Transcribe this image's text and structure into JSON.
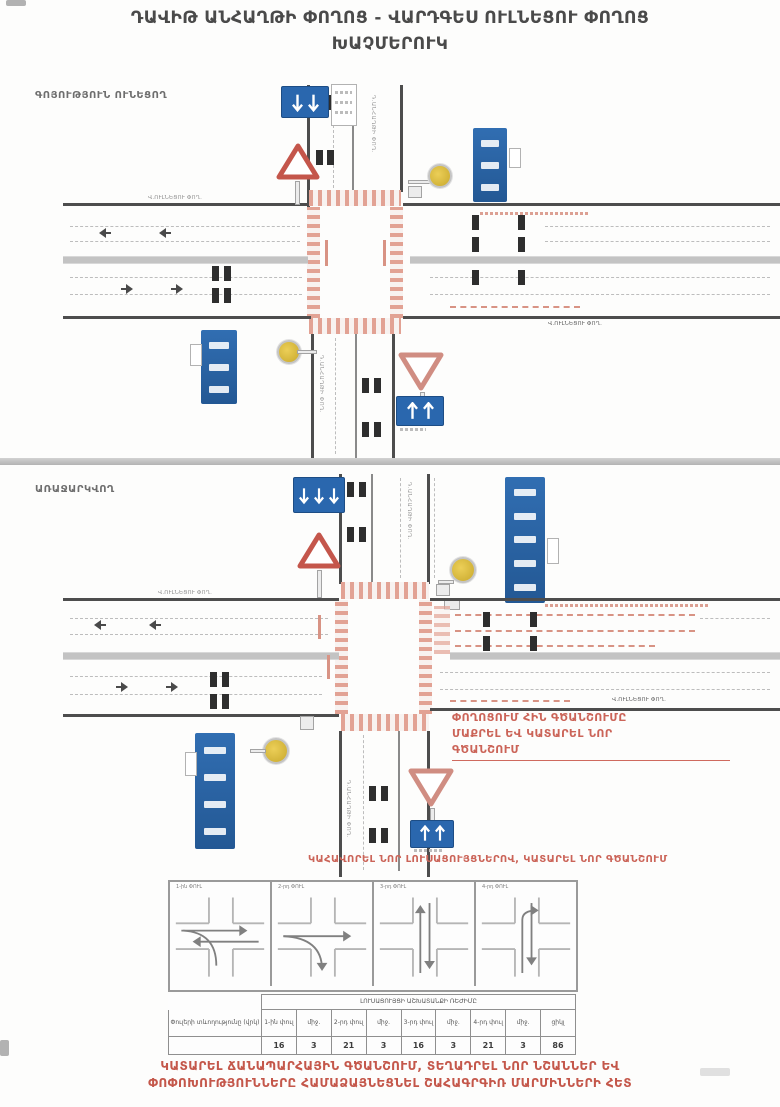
{
  "title": {
    "line1": "ԴԱՎԻԹ ԱՆՀԱՂԹԻ ՓՈՂՈՑ - ՎԱՐԴԳԵՍ ՈՒԼՆԵՑՈՒ ՓՈՂՈՑ",
    "line2": "ԽԱՉՄԵՐՈՒԿ"
  },
  "sections": {
    "existing_label": "ԳՈՅՈՒԹՅՈՒՆ ՈՒՆԵՑՈՂ",
    "proposed_label": "ԱՌԱՋԱՐԿՎՈՂ"
  },
  "streets": {
    "horizontal": "Վ.ՈՒԼՆԵՑՈՒ ՓՈՂ.",
    "vertical": "Դ.ԱՆՀԱՂԹԻ ՓՈՂ."
  },
  "notes": {
    "marking_note_line1": "ՓՈՂՈՑՈՒՄ ՀԻՆ ԳԾԱՆՇՈՒՄԸ",
    "marking_note_line2": "ՄԱՔՐԵԼ ԵՎ ԿԱՏԱՐԵԼ ՆՈՐ",
    "marking_note_line3": "ԳԾԱՆՇՈՒՄ",
    "signal_note": "ԿԱՀԱՎՈՐԵԼ ՆՈՐ ԼՈՒՍԱՑՈՒՅՑՆԵՐՈՎ, ԿԱՏԱՐԵԼ ՆՈՐ ԳԾԱՆՇՈՒՄ"
  },
  "phases": {
    "labels": [
      "1-ին ՓՈՒԼ",
      "2-րդ ՓՈՒԼ",
      "3-րդ ՓՈՒԼ",
      "4-րդ ՓՈՒԼ"
    ]
  },
  "table": {
    "title": "ԼՈՒՍԱՑՈՒՅՑԻ ԱՇԽԱՏԱՆՔԻ ՌԵԺԻՄԸ",
    "row_label": "Փուլերի տևողությունը (վրկ)",
    "columns": [
      "1-ին փուլ",
      "միջ.",
      "2-րդ փուլ",
      "միջ.",
      "3-րդ փուլ",
      "միջ.",
      "4-րդ փուլ",
      "միջ.",
      "ցիկլ"
    ],
    "values": [
      "16",
      "3",
      "21",
      "3",
      "16",
      "3",
      "21",
      "3",
      "86"
    ]
  },
  "footer": {
    "line1": "ԿԱՏԱՐԵԼ ՃԱՆԱՊԱՐՀԱՅԻՆ ԳԾԱՆՇՈՒՄ, ՏԵՂԱԴՐԵԼ ՆՈՐ ՆՇԱՆՆԵՐ ԵՎ",
    "line2": "ՓՈՓՈԽՈՒԹՅՈՒՆՆԵՐԸ ՀԱՄԱՁԱՅՆԵՑՆԵԼ ՇԱՀԱԳՐԳԻՌ ՄԱՐՄԻՆՆԵՐԻ ՀԵՏ"
  },
  "colors": {
    "sign_blue": "#2a67ae",
    "marking_salmon": "#e2a294",
    "note_red": "#cb6458",
    "road_dark": "#4d4d4d",
    "signal_yellow": "#d9b832"
  }
}
